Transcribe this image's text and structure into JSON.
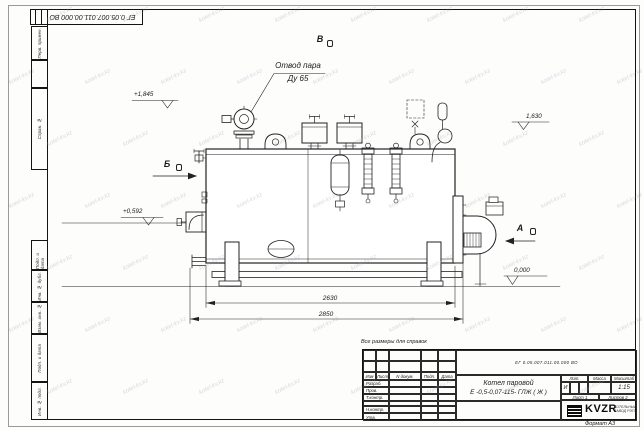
{
  "watermark": {
    "text": "kotel-kv.kz"
  },
  "frame": {
    "top_stamp": "ЕГ 0.05.007.011.00.000  ВО",
    "format_label": "Формат А3",
    "side_labels": [
      "Перв. примен.",
      "Справ. №",
      "Подп. и дата",
      "Инв. № дубл.",
      "Взам. инв. №",
      "Подп. и дата",
      "Инв. № подл."
    ]
  },
  "annotations": {
    "steam_outlet_line1": "Отвод пара",
    "steam_outlet_line2": "Ду 65",
    "view_top": "В",
    "view_left": "Б",
    "view_right": "А",
    "elev_top_left": "+1,845",
    "elev_top_right": "1,630",
    "elev_mid_left": "+0,592",
    "elev_ground": "0,000",
    "dim_inner": "2630",
    "dim_outer": "2850",
    "reference_note": "Все размеры для справок"
  },
  "title_block": {
    "doc_number": "ЕГ 0.05.007.011.00.000  ВО",
    "name_line1": "Котел паровой",
    "name_line2": "Е -0,5-0,07-115- ГЛЖ ( Ж )",
    "col_izm": "Изм",
    "col_list": "Лист",
    "col_doc": "N докум.",
    "col_podp": "Подп.",
    "col_data": "Дата",
    "row_labels": [
      "Разраб.",
      "Пров.",
      "Т.контр.",
      "",
      "Н.контр.",
      "Утв."
    ],
    "lit_header": "Лит.",
    "mass_header": "Масса",
    "scale_header": "Масштаб",
    "lit_value": "И",
    "scale_value": "1:15",
    "sheet_label": "Лист",
    "sheet_value": "1",
    "sheets_label": "Листов",
    "sheets_value": "2",
    "logo_text": "KVZR",
    "logo_caption1": "КОТЕЛЬНЫЙ",
    "logo_caption2": "ЗАВОД РЭП"
  }
}
